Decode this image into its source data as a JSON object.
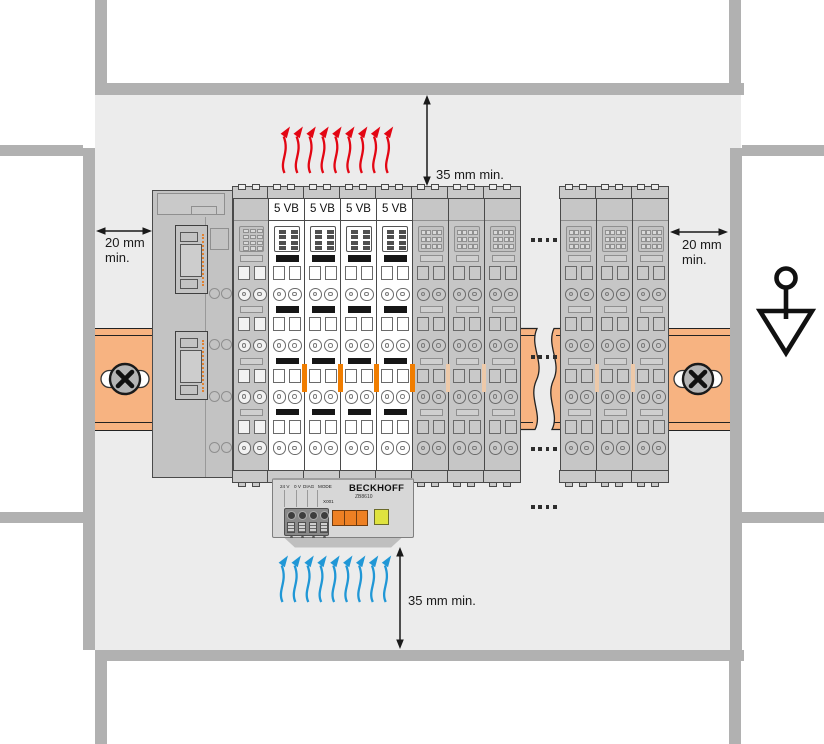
{
  "diagram_type": "installation-clearance-diagram",
  "dimensions": {
    "top": "35 mm min.",
    "bottom": "35 mm min.",
    "left_line1": "20 mm",
    "left_line2": "min.",
    "right_line1": "20 mm",
    "right_line2": "min."
  },
  "rail_assembly": {
    "left_group": [
      {
        "type": "coupler"
      },
      {
        "type": "power-feed"
      },
      {
        "type": "io-white",
        "label": "5 VB"
      },
      {
        "type": "io-white",
        "label": "5 VB"
      },
      {
        "type": "io-white",
        "label": "5 VB"
      },
      {
        "type": "io-white",
        "label": "5 VB"
      },
      {
        "type": "io-gray"
      },
      {
        "type": "io-gray"
      },
      {
        "type": "io-gray"
      }
    ],
    "right_group": [
      {
        "type": "io-gray"
      },
      {
        "type": "io-gray"
      },
      {
        "type": "io-gray"
      }
    ]
  },
  "fan": {
    "brand": "BECKHOFF",
    "model": "ZB8610",
    "terminal_labels": [
      "24 V",
      "0 V",
      "DIAG",
      "MODE"
    ],
    "connector_label": "X001"
  },
  "airflow": {
    "top_count": 9,
    "bottom_count": 9
  },
  "continuation_dots_groups": 4,
  "colors": {
    "panel": "#ececec",
    "frame": "#b1b1b1",
    "rail": "#f7b381",
    "module_gray": "#c6c6c6",
    "module_cap": "#c9c9c9",
    "red_arrow": "#e30613",
    "blue_arrow": "#2097d6",
    "orange_accent": "#f07d00",
    "fan_body": "#d7d7d7",
    "fan_orange": "#ee8023",
    "fan_led_yellow": "#dfe33f",
    "connector": "#898989"
  }
}
